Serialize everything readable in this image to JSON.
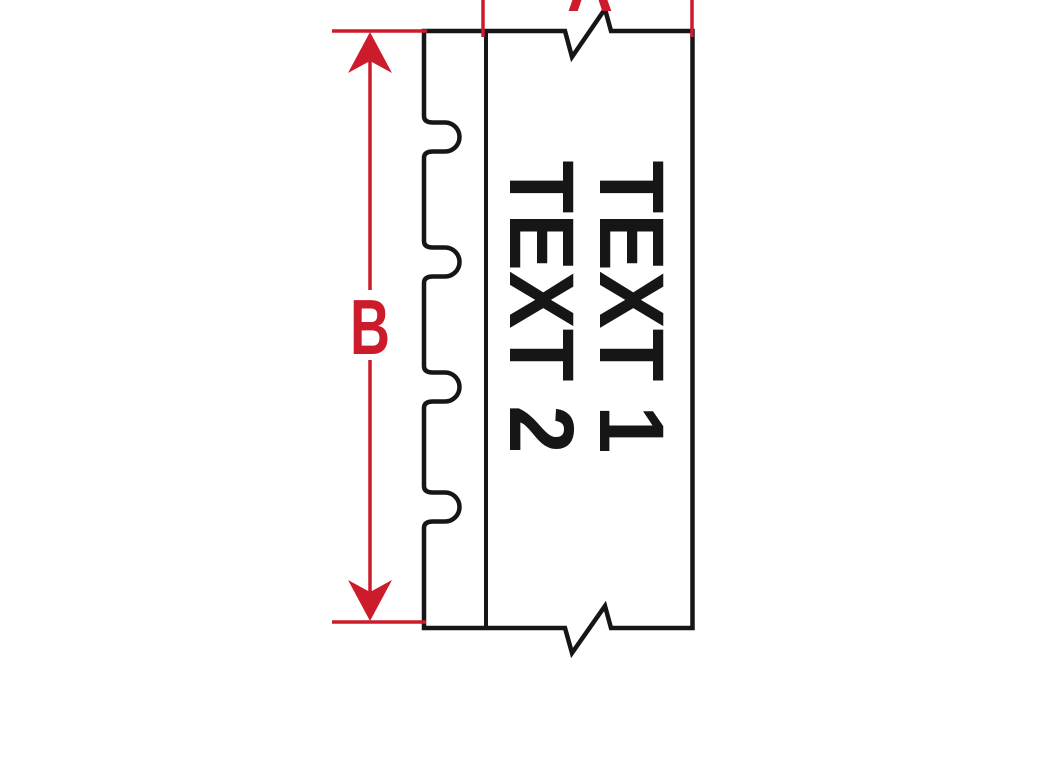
{
  "colors": {
    "red": "#cc1b2a",
    "black": "#161616",
    "background": "#ffffff"
  },
  "sleeve": {
    "text_line1": "TEXT 1",
    "text_line2": "TEXT 2"
  },
  "dimensions": {
    "vertical_label": "B",
    "horizontal_label": "A"
  }
}
